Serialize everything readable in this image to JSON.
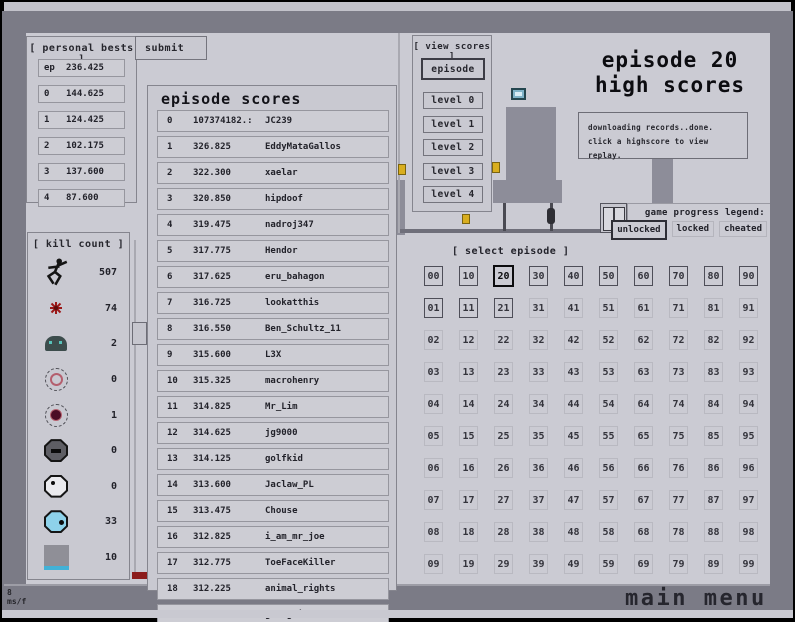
{
  "personal_bests": {
    "header": "[ personal bests ]",
    "rows": [
      {
        "label": "ep",
        "value": "236.425"
      },
      {
        "label": "0",
        "value": "144.625"
      },
      {
        "label": "1",
        "value": "124.425"
      },
      {
        "label": "2",
        "value": "102.175"
      },
      {
        "label": "3",
        "value": "137.600"
      },
      {
        "label": "4",
        "value": "87.600"
      }
    ]
  },
  "submit": {
    "label": "submit"
  },
  "episode_scores": {
    "title": "episode scores",
    "rows": [
      {
        "rank": "0",
        "score": "107374182.:",
        "name": "JC239"
      },
      {
        "rank": "1",
        "score": "326.825",
        "name": "EddyMataGallos"
      },
      {
        "rank": "2",
        "score": "322.300",
        "name": "xaelar"
      },
      {
        "rank": "3",
        "score": "320.850",
        "name": "hipdoof"
      },
      {
        "rank": "4",
        "score": "319.475",
        "name": "nadroj347"
      },
      {
        "rank": "5",
        "score": "317.775",
        "name": "Hendor"
      },
      {
        "rank": "6",
        "score": "317.625",
        "name": "eru_bahagon"
      },
      {
        "rank": "7",
        "score": "316.725",
        "name": "lookatthis"
      },
      {
        "rank": "8",
        "score": "316.550",
        "name": "Ben_Schultz_11"
      },
      {
        "rank": "9",
        "score": "315.600",
        "name": "L3X"
      },
      {
        "rank": "10",
        "score": "315.325",
        "name": "macrohenry"
      },
      {
        "rank": "11",
        "score": "314.825",
        "name": "Mr_Lim"
      },
      {
        "rank": "12",
        "score": "314.625",
        "name": "jg9000"
      },
      {
        "rank": "13",
        "score": "314.125",
        "name": "golfkid"
      },
      {
        "rank": "14",
        "score": "313.600",
        "name": "Jaclaw_PL"
      },
      {
        "rank": "15",
        "score": "313.475",
        "name": "Chouse"
      },
      {
        "rank": "16",
        "score": "312.825",
        "name": "i_am_mr_joe"
      },
      {
        "rank": "17",
        "score": "312.775",
        "name": "ToeFaceKiller"
      },
      {
        "rank": "18",
        "score": "312.225",
        "name": "animal_rights"
      },
      {
        "rank": "19",
        "score": "311.925",
        "name": "gahngdi"
      }
    ]
  },
  "kill_count": {
    "header": "[ kill count ]",
    "items": [
      {
        "icon": "ninja-icon",
        "count": "507"
      },
      {
        "icon": "mine-icon",
        "count": "74"
      },
      {
        "icon": "robot-icon",
        "count": "2"
      },
      {
        "icon": "seeker-drone-icon",
        "count": "0"
      },
      {
        "icon": "orb-drone-icon",
        "count": "1"
      },
      {
        "icon": "dark-octagon-icon",
        "count": "0"
      },
      {
        "icon": "white-octagon-icon",
        "count": "0"
      },
      {
        "icon": "cyan-octagon-icon",
        "count": "33"
      },
      {
        "icon": "turret-icon",
        "count": "10"
      }
    ]
  },
  "view_scores": {
    "header": "[ view scores ]",
    "episode_button": "episode",
    "level_buttons": [
      "level 0",
      "level 1",
      "level 2",
      "level 3",
      "level 4"
    ]
  },
  "title": {
    "line1": "episode 20",
    "line2": "high scores"
  },
  "status_box": {
    "lines": [
      "downloading records..done.",
      "click a highscore to view replay."
    ]
  },
  "legend": {
    "label": "game progress legend:",
    "items": [
      {
        "label": "unlocked",
        "state": "unlocked"
      },
      {
        "label": "locked",
        "state": "locked"
      },
      {
        "label": "cheated",
        "state": "cheated"
      }
    ]
  },
  "select_episode": {
    "header": "[ select episode ]",
    "selected": "20",
    "unlocked": [
      "00",
      "10",
      "20",
      "30",
      "40",
      "50",
      "60",
      "70",
      "80",
      "90",
      "01",
      "11",
      "21"
    ],
    "cells": [
      "00",
      "10",
      "20",
      "30",
      "40",
      "50",
      "60",
      "70",
      "80",
      "90",
      "01",
      "11",
      "21",
      "31",
      "41",
      "51",
      "61",
      "71",
      "81",
      "91",
      "02",
      "12",
      "22",
      "32",
      "42",
      "52",
      "62",
      "72",
      "82",
      "92",
      "03",
      "13",
      "23",
      "33",
      "43",
      "53",
      "63",
      "73",
      "83",
      "93",
      "04",
      "14",
      "24",
      "34",
      "44",
      "54",
      "64",
      "74",
      "84",
      "94",
      "05",
      "15",
      "25",
      "35",
      "45",
      "55",
      "65",
      "75",
      "85",
      "95",
      "06",
      "16",
      "26",
      "36",
      "46",
      "56",
      "66",
      "76",
      "86",
      "96",
      "07",
      "17",
      "27",
      "37",
      "47",
      "57",
      "67",
      "77",
      "87",
      "97",
      "08",
      "18",
      "28",
      "38",
      "48",
      "58",
      "68",
      "78",
      "88",
      "98",
      "09",
      "19",
      "29",
      "39",
      "49",
      "59",
      "69",
      "79",
      "89",
      "99"
    ]
  },
  "footer": {
    "frame_ms": "8",
    "frame_unit": "ms/f",
    "main_menu": "main menu"
  },
  "colors": {
    "panel": "#c9c9d1",
    "wall": "#8d8d99",
    "band": "#7b7b86",
    "level": "#cbcbd3",
    "gold": "#d9ae1f",
    "red": "#8c1c1c",
    "cyan": "#42b1d6"
  }
}
